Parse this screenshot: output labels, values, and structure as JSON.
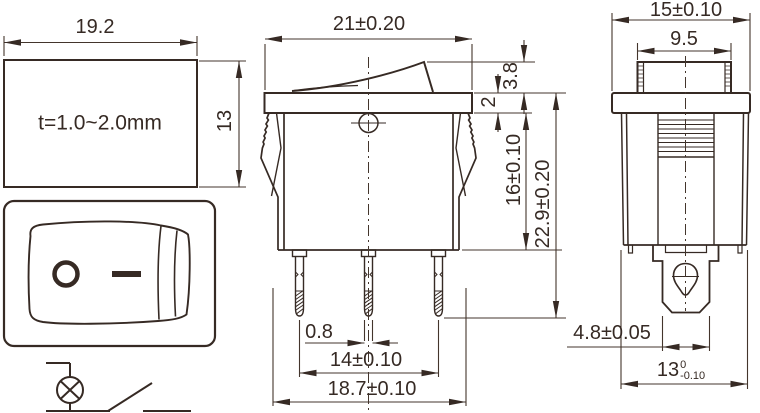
{
  "colors": {
    "line": "#362a24",
    "dim": "#43352c",
    "background": "#ffffff"
  },
  "cutout_view": {
    "width": "19.2",
    "height": "13",
    "thickness_note": "t=1.0~2.0mm"
  },
  "front_view": {
    "off_symbol": "O",
    "on_symbol": "—"
  },
  "main_view": {
    "width": "21±0.20",
    "flange_thickness": "2",
    "rocker_height": "3.8",
    "body_depth": "16±0.10",
    "overall_height": "22.9±0.20",
    "pin_thickness": "0.8",
    "pin_pitch": "14±0.10",
    "body_width": "18.7±0.10"
  },
  "end_view": {
    "flange_width": "15±0.10",
    "rocker_width": "9.5",
    "terminal_width": "4.8±0.05",
    "body_width_nominal": "13",
    "body_width_tol_upper": "0",
    "body_width_tol_lower": "-0.10"
  }
}
